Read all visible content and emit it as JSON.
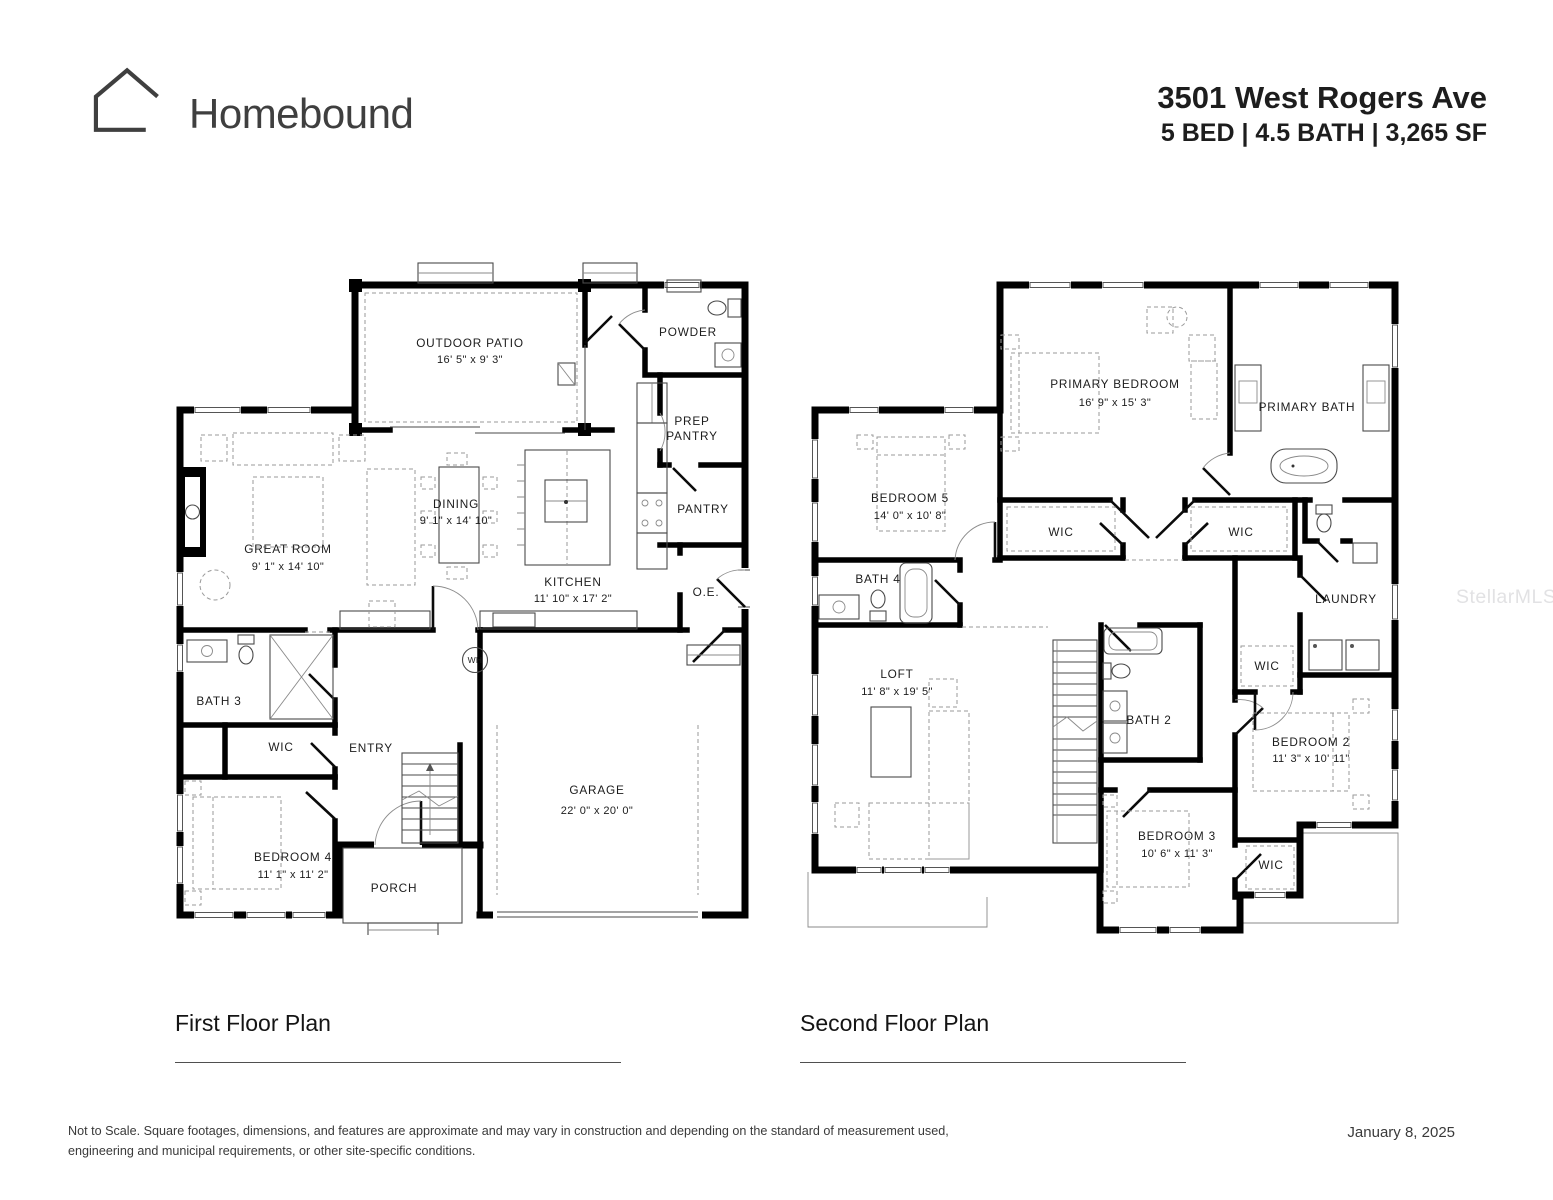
{
  "header": {
    "brand": "Homebound",
    "address": "3501 West Rogers Ave",
    "specs": "5 BED | 4.5 BATH | 3,265 SF"
  },
  "watermark": "StellarMLS",
  "colors": {
    "wall": "#000000",
    "label_text": "#1c1c1c",
    "brand_text": "#3f3f3f",
    "watermark": "#e2e2e4"
  },
  "first_floor": {
    "title": "First Floor Plan",
    "rooms": {
      "outdoor_patio": {
        "name": "OUTDOOR PATIO",
        "dims": "16' 5\" x 9' 3\""
      },
      "powder": {
        "name": "POWDER"
      },
      "prep_pantry": {
        "line1": "PREP",
        "line2": "PANTRY"
      },
      "pantry": {
        "name": "PANTRY"
      },
      "dining": {
        "name": "DINING",
        "dims": "9' 1\" x 14' 10\""
      },
      "great_room": {
        "name": "GREAT ROOM",
        "dims": "9' 1\" x 14' 10\""
      },
      "kitchen": {
        "name": "KITCHEN",
        "dims": "11' 10\" x 17' 2\""
      },
      "oe": {
        "name": "O.E."
      },
      "wh": {
        "name": "WH"
      },
      "bath3": {
        "name": "BATH 3"
      },
      "wic": {
        "name": "WIC"
      },
      "entry": {
        "name": "ENTRY"
      },
      "bedroom4": {
        "name": "BEDROOM 4",
        "dims": "11' 1\" x 11' 2\""
      },
      "porch": {
        "name": "PORCH"
      },
      "garage": {
        "name": "GARAGE",
        "dims": "22' 0\" x 20' 0\""
      }
    }
  },
  "second_floor": {
    "title": "Second Floor Plan",
    "rooms": {
      "primary_bedroom": {
        "name": "PRIMARY BEDROOM",
        "dims": "16' 9\" x 15' 3\""
      },
      "primary_bath": {
        "name": "PRIMARY BATH"
      },
      "bedroom5": {
        "name": "BEDROOM 5",
        "dims": "14' 0\" x 10' 8\""
      },
      "bath4": {
        "name": "BATH 4"
      },
      "wic_left": {
        "name": "WIC"
      },
      "wic_right": {
        "name": "WIC"
      },
      "laundry": {
        "name": "LAUNDRY"
      },
      "wic_bedroom2": {
        "name": "WIC"
      },
      "loft": {
        "name": "LOFT",
        "dims": "11' 8\" x 19' 5\""
      },
      "bath2": {
        "name": "BATH 2"
      },
      "bedroom2": {
        "name": "BEDROOM 2",
        "dims": "11' 3\" x 10' 11\""
      },
      "bedroom3": {
        "name": "BEDROOM 3",
        "dims": "10' 6\" x 11' 3\""
      },
      "wic_bedroom3": {
        "name": "WIC"
      }
    }
  },
  "footer": {
    "disclaimer1": "Not to Scale. Square footages, dimensions, and features are approximate and may vary in construction and depending on the standard of measurement used,",
    "disclaimer2": "engineering and municipal requirements, or other site-specific conditions.",
    "date": "January 8, 2025"
  }
}
